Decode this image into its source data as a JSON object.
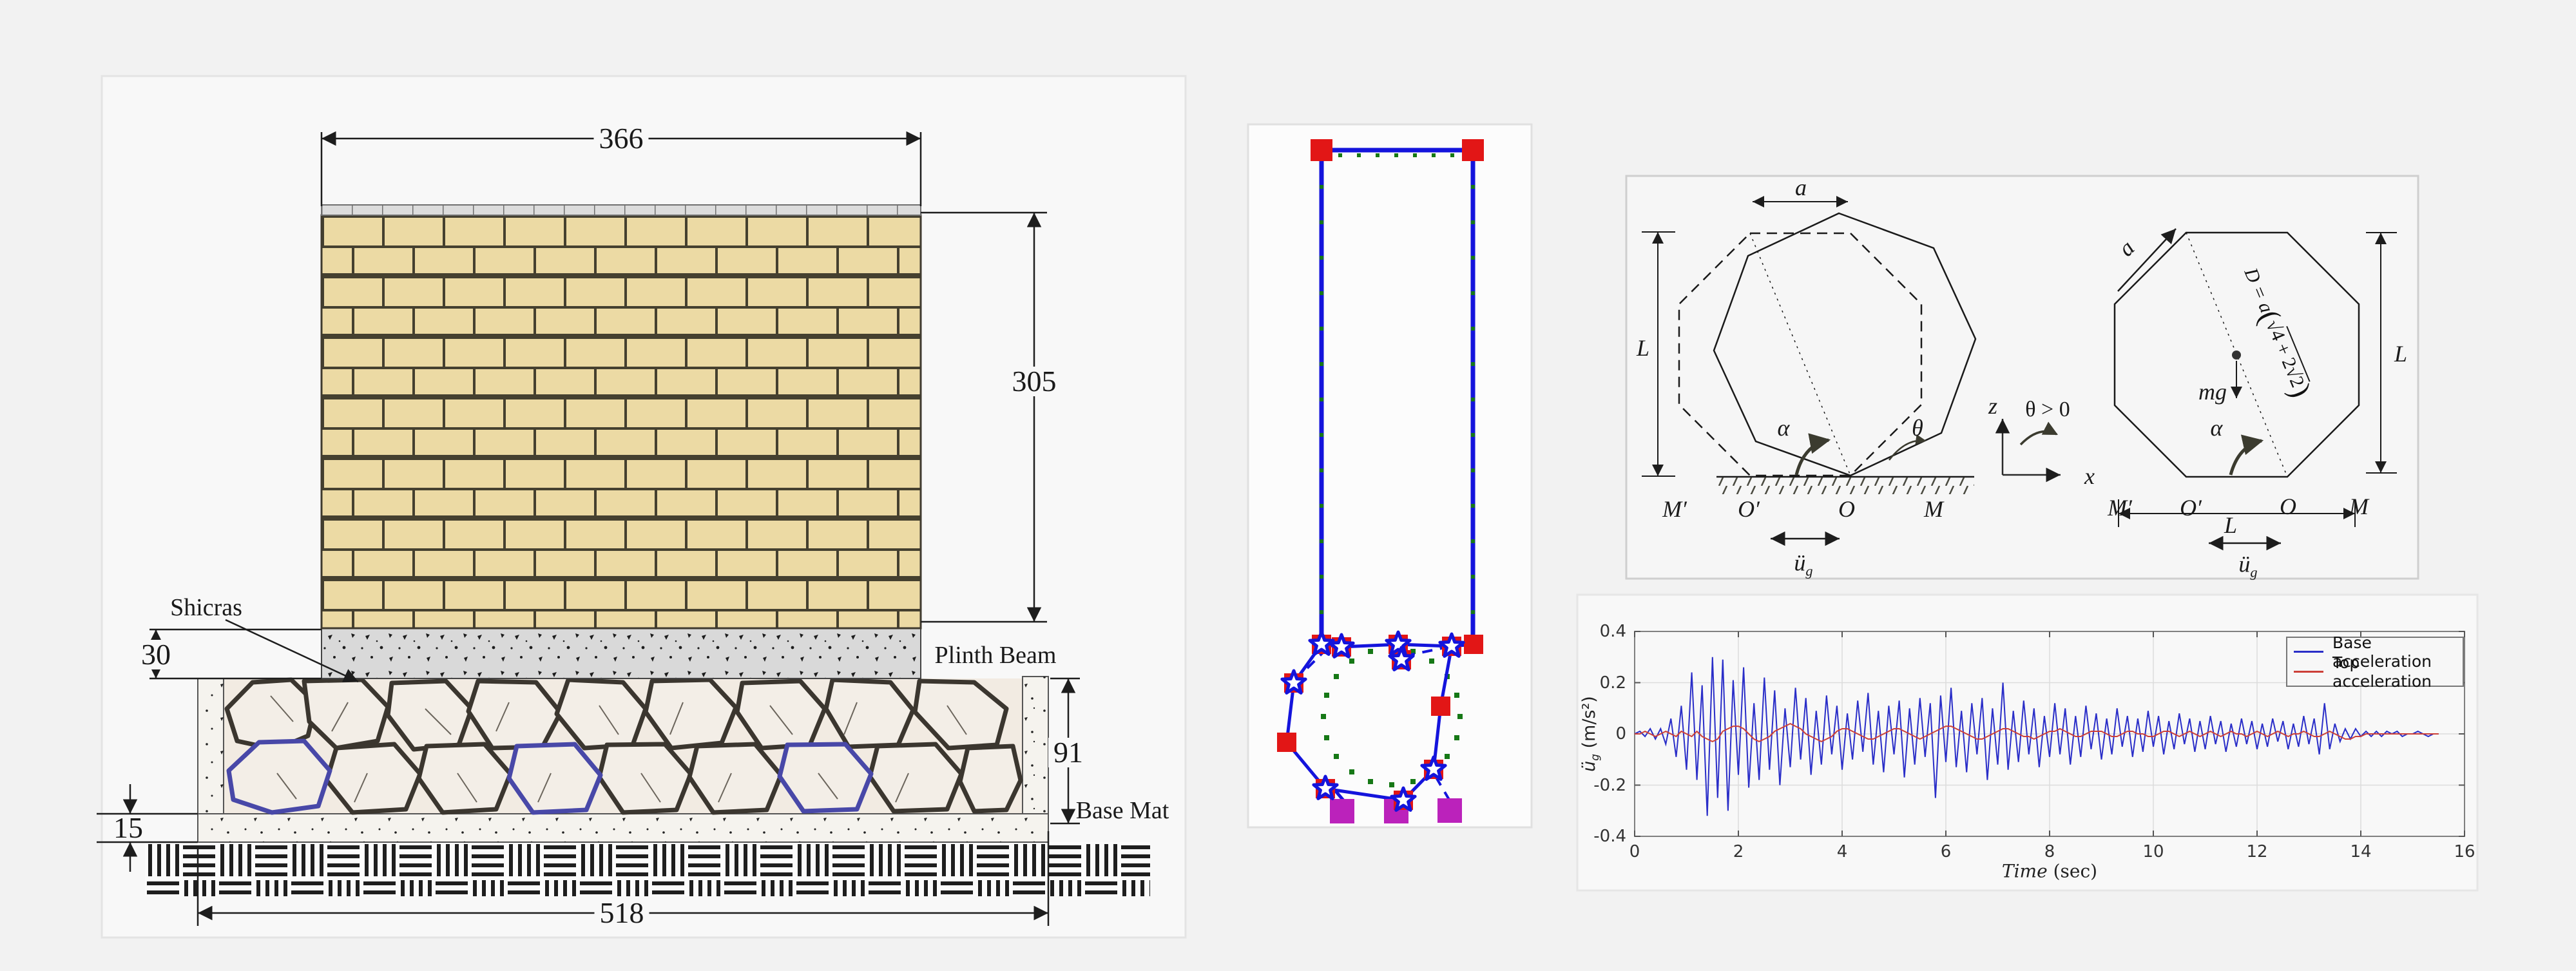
{
  "page": {
    "background": "#f2f2f2"
  },
  "left_diagram": {
    "dimensions": {
      "wall_width": "366",
      "wall_height": "305",
      "plinth_thickness": "30",
      "fill_height": "91",
      "slab_thickness": "15",
      "base_width": "518"
    },
    "labels": {
      "shicras": "Shicras",
      "plinth_beam": "Plinth Beam",
      "base_mat": "Base Mat"
    },
    "colors": {
      "brick_fill": "#ecdaa4",
      "mortar": "#45402f",
      "plinth_concrete": "#d9d9d9",
      "stone_outline": "#3b362f",
      "stone_blue": "#4848a8"
    }
  },
  "fem_model": {
    "colors": {
      "frame_blue": "#1414dc",
      "node_red": "#e21616",
      "gauss_green": "#167816",
      "support_magenta": "#bb22bb"
    }
  },
  "octagon_figure": {
    "labels": {
      "a": "a",
      "L": "L",
      "alpha": "α",
      "theta": "θ",
      "theta_positive": "θ > 0",
      "z": "z",
      "x": "x",
      "mg": "mg",
      "M_prime": "M′",
      "O_prime": "O′",
      "O": "O",
      "M": "M",
      "u_ddot": "ü",
      "u_sub": "g",
      "D_prefix": "D = a",
      "paren_open": "(",
      "radical": "√",
      "radicand": "4 + 2√2",
      "paren_close": ")"
    }
  },
  "chart_data": {
    "type": "line",
    "title": "",
    "xlabel_italic": "Time",
    "xlabel_rest": " (sec)",
    "ylabel": {
      "dd": "ü",
      "sub": "g",
      "rest": " (m/s²)"
    },
    "xlim": [
      0,
      16
    ],
    "ylim": [
      -0.4,
      0.4
    ],
    "xticks": [
      0,
      2,
      4,
      6,
      8,
      10,
      12,
      14,
      16
    ],
    "xtick_labels": [
      "0",
      "2",
      "4",
      "6",
      "8",
      "10",
      "12",
      "14",
      "16"
    ],
    "yticks": [
      -0.4,
      -0.2,
      0,
      0.2,
      0.4
    ],
    "ytick_labels": [
      "-0.4",
      "-0.2",
      "0",
      "0.2",
      "0.4"
    ],
    "grid": true,
    "legend_position": "top-right",
    "t0": 0,
    "dt": 0.1,
    "series": [
      {
        "name": "Base acceleration",
        "color": "#2a2ec8",
        "values": [
          0.0,
          0.01,
          -0.01,
          0.02,
          -0.02,
          0.02,
          -0.04,
          0.06,
          -0.09,
          0.11,
          -0.14,
          0.24,
          -0.18,
          0.19,
          -0.32,
          0.3,
          -0.25,
          0.29,
          -0.3,
          0.21,
          -0.16,
          0.26,
          -0.21,
          0.12,
          -0.18,
          0.22,
          -0.14,
          0.17,
          -0.2,
          0.1,
          -0.13,
          0.18,
          -0.1,
          0.14,
          -0.16,
          0.09,
          -0.12,
          0.15,
          -0.08,
          0.11,
          -0.14,
          0.08,
          -0.1,
          0.13,
          -0.07,
          0.16,
          -0.12,
          0.09,
          -0.15,
          0.11,
          -0.08,
          0.13,
          -0.17,
          0.1,
          -0.12,
          0.14,
          -0.09,
          0.12,
          -0.25,
          0.15,
          -0.11,
          0.18,
          -0.13,
          0.09,
          -0.15,
          0.12,
          -0.08,
          0.14,
          -0.18,
          0.1,
          -0.12,
          0.2,
          -0.14,
          0.09,
          -0.11,
          0.13,
          -0.08,
          0.1,
          -0.13,
          0.07,
          -0.09,
          0.12,
          -0.08,
          0.1,
          -0.12,
          0.07,
          -0.09,
          0.11,
          -0.06,
          0.08,
          -0.1,
          0.06,
          -0.08,
          0.1,
          -0.05,
          0.07,
          -0.09,
          0.06,
          -0.07,
          0.09,
          -0.05,
          0.07,
          -0.08,
          0.05,
          -0.06,
          0.08,
          -0.04,
          0.06,
          -0.07,
          0.05,
          -0.06,
          0.07,
          -0.04,
          0.05,
          -0.07,
          0.04,
          -0.05,
          0.06,
          -0.04,
          0.05,
          -0.06,
          0.04,
          -0.05,
          0.06,
          -0.03,
          0.05,
          -0.06,
          0.04,
          -0.05,
          0.07,
          -0.04,
          0.06,
          -0.08,
          0.12,
          -0.06,
          0.04,
          -0.03,
          0.02,
          -0.02,
          0.02,
          -0.01,
          0.01,
          -0.01,
          0.01,
          -0.01,
          0.01,
          0.0,
          0.01,
          -0.01,
          0.0,
          0.0,
          0.01,
          0.0,
          -0.01,
          0.0,
          0.0
        ]
      },
      {
        "name": "Top acceleration",
        "color": "#cc4038",
        "values": [
          0.0,
          0.0,
          0.01,
          0.0,
          -0.01,
          0.0,
          0.01,
          0.0,
          -0.01,
          0.01,
          0.0,
          -0.01,
          0.01,
          -0.01,
          -0.02,
          -0.03,
          -0.02,
          0.01,
          0.02,
          0.03,
          0.03,
          0.02,
          0.0,
          -0.02,
          -0.03,
          -0.02,
          -0.01,
          0.01,
          0.02,
          0.03,
          0.04,
          0.03,
          0.02,
          0.0,
          -0.01,
          -0.02,
          -0.03,
          -0.02,
          -0.01,
          0.01,
          0.02,
          0.02,
          0.01,
          0.0,
          -0.01,
          -0.02,
          -0.02,
          -0.01,
          0.0,
          0.01,
          0.02,
          0.02,
          0.01,
          0.0,
          -0.01,
          -0.02,
          -0.01,
          0.0,
          0.01,
          0.02,
          0.03,
          0.03,
          0.02,
          0.01,
          0.0,
          -0.01,
          -0.02,
          -0.02,
          -0.01,
          0.0,
          0.01,
          0.02,
          0.02,
          0.01,
          0.0,
          -0.01,
          -0.01,
          -0.02,
          -0.01,
          0.0,
          0.01,
          0.01,
          0.02,
          0.01,
          0.0,
          -0.01,
          -0.01,
          0.0,
          0.01,
          0.01,
          0.01,
          0.0,
          -0.01,
          -0.01,
          0.0,
          0.01,
          0.01,
          0.0,
          0.0,
          -0.01,
          -0.01,
          0.0,
          0.01,
          0.01,
          0.0,
          -0.01,
          0.0,
          0.01,
          0.0,
          -0.01,
          0.0,
          0.01,
          0.0,
          -0.01,
          0.0,
          0.01,
          0.0,
          0.0,
          -0.01,
          0.0,
          0.01,
          0.0,
          -0.01,
          0.0,
          0.01,
          0.0,
          -0.01,
          0.0,
          0.0,
          0.01,
          0.0,
          -0.01,
          -0.01,
          0.0,
          0.01,
          0.0,
          -0.01,
          -0.02,
          -0.02,
          -0.01,
          -0.01,
          0.0,
          0.0,
          0.0,
          0.0,
          0.0,
          0.0,
          0.0,
          0.0,
          0.0,
          0.0,
          0.0,
          0.0,
          0.0,
          0.0,
          0.0
        ]
      }
    ]
  }
}
